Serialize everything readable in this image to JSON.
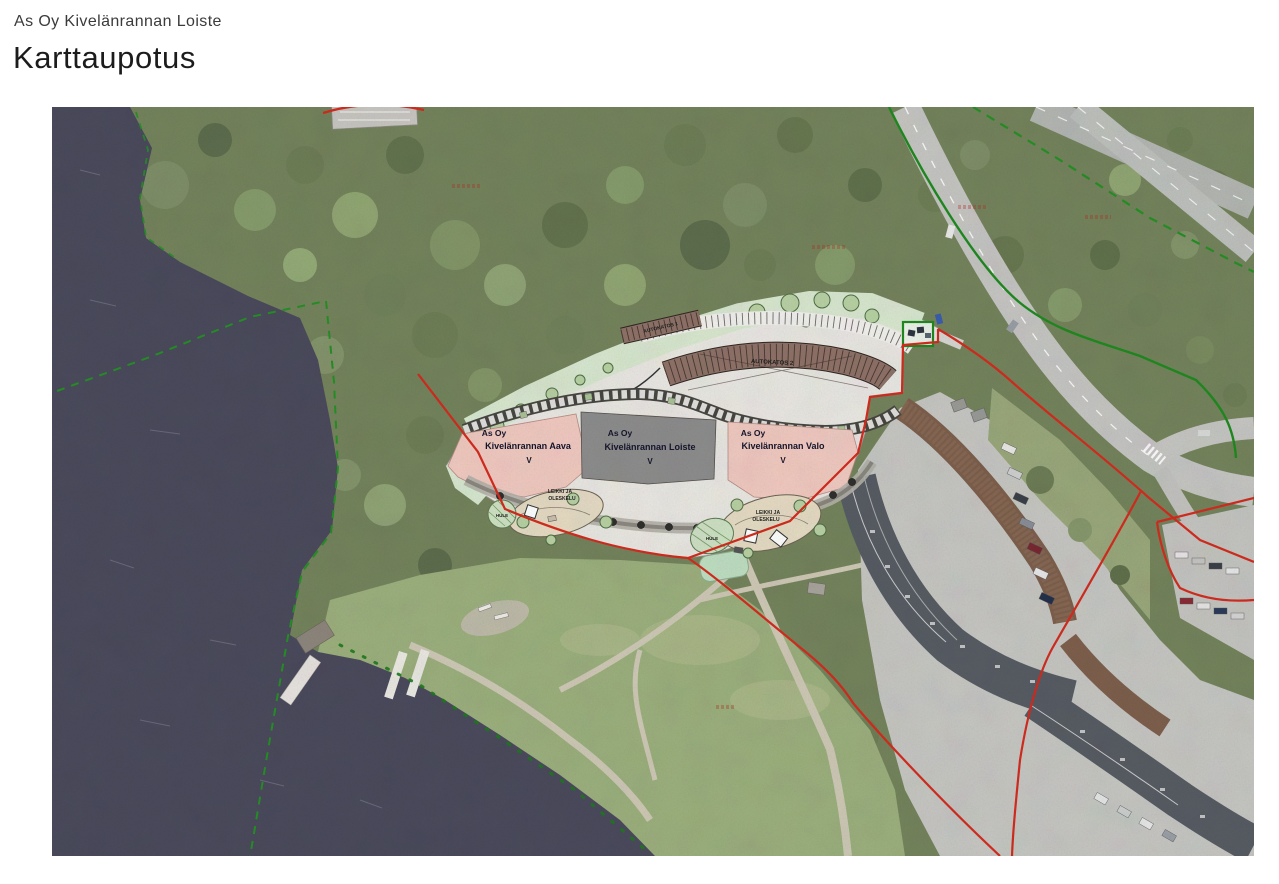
{
  "page": {
    "header": "As Oy Kivelänrannan Loiste",
    "title": "Karttaupotus"
  },
  "map": {
    "buildings": [
      {
        "id": "aava",
        "line1": "As Oy",
        "line2": "Kivelänrannan Aava",
        "floors": "V",
        "fill": "#f1cac1"
      },
      {
        "id": "loiste",
        "line1": "As Oy",
        "line2": "Kivelänrannan Loiste",
        "floors": "V",
        "fill": "#8d8d8d"
      },
      {
        "id": "valo",
        "line1": "As Oy",
        "line2": "Kivelänrannan Valo",
        "floors": "V",
        "fill": "#f1cac1"
      }
    ],
    "annotations": {
      "carport_1": "AUTOKATOS 1",
      "carport_2": "AUTOKATOS 2",
      "play_line1": "LEIKKI JA",
      "play_line2": "OLESKELU",
      "stormwater": "HULE"
    },
    "colors": {
      "water": "#4a4a5c",
      "forest": "#74845c",
      "grass": "#9cb07d",
      "sand": "#dcd2b4",
      "road": "#c6c6c3",
      "plan_background": "#eae8e3",
      "plan_green": "#d9e8d0",
      "carport_brown": "#8f7268",
      "existing_building": "#575c63",
      "boundary_red": "#d42b1e",
      "boundary_green": "#1f8a1f"
    }
  }
}
